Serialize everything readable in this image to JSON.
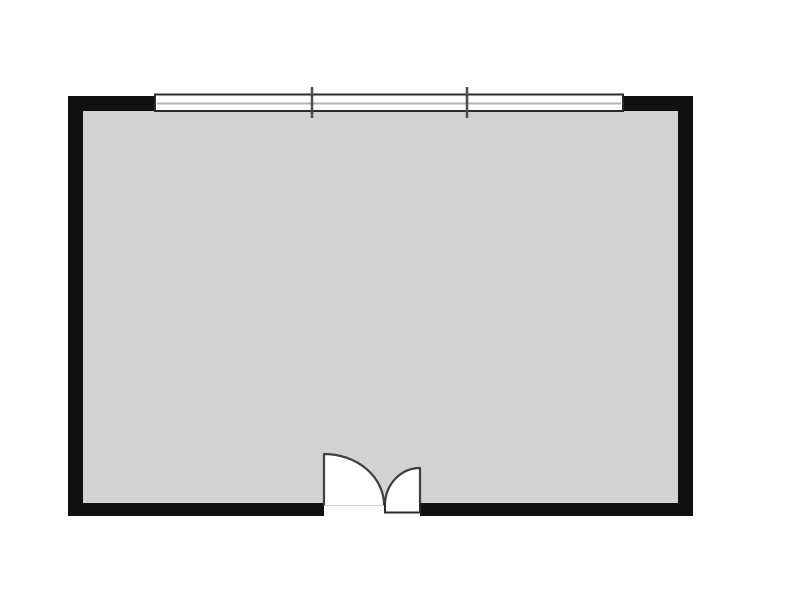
{
  "canvas": {
    "width": 787,
    "height": 609
  },
  "colors": {
    "background": "#ffffff",
    "wall": "#101010",
    "floor": "#d2d2d2",
    "window_fill": "#ffffff",
    "window_frame": "#2b2b2b",
    "window_center_line": "#b3b3b3",
    "window_tick": "#4d4d4d",
    "door_fill": "#ffffff",
    "door_outline": "#3f3f3f",
    "door_closed_outline": "#2b2b2b",
    "threshold": "#9c9c9c"
  },
  "room": {
    "wall_thickness": 15,
    "outer": {
      "x": 68,
      "y": 96,
      "width": 625,
      "height": 420
    },
    "floor": {
      "x": 83,
      "y": 111,
      "width": 595,
      "height": 392
    },
    "walls_path": "M68,96 H693 V516 H68 Z M83,111 H678 V503 H83 Z"
  },
  "window": {
    "rect": {
      "x": 155,
      "y": 94.5,
      "width": 468,
      "height": 16.5
    },
    "center_line": {
      "x1": 157,
      "y1": 103.5,
      "x2": 621,
      "y2": 103.5
    },
    "ticks": [
      {
        "x1": 312,
        "y1": 87,
        "x2": 312,
        "y2": 118
      },
      {
        "x1": 467,
        "y1": 87,
        "x2": 467,
        "y2": 118
      }
    ]
  },
  "door": {
    "opening": {
      "x": 324,
      "y": 503,
      "width": 96,
      "height": 13
    },
    "threshold": {
      "x1": 324,
      "y1": 504.5,
      "x2": 420,
      "y2": 504.5
    },
    "left_leaf_path": "M324,505 L324,454 A60,51 0 0 1 384,505",
    "right_leaf_path": "M420,505 L420,468 A35,37 0 0 0 385,505",
    "closed_leaf_path": "M385,503 L385,512.5 L420,512.5 L420,503"
  }
}
